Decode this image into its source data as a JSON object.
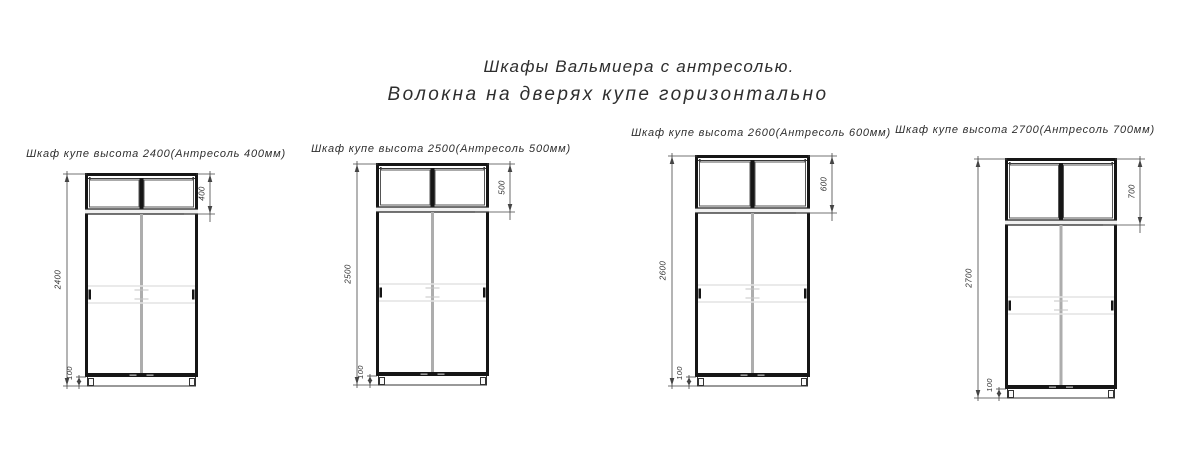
{
  "titles": {
    "line1": "Шкафы Вальмиера с антресолью.",
    "line2": "Волокна на дверях купе горизонтально"
  },
  "cabinets": [
    {
      "label": "Шкаф купе высота 2400(Антресоль 400мм)",
      "height_mm": "2400",
      "mezzanine_mm": "400",
      "plinth_mm": "100"
    },
    {
      "label": "Шкаф купе высота 2500(Антресоль 500мм)",
      "height_mm": "2500",
      "mezzanine_mm": "500",
      "plinth_mm": "100"
    },
    {
      "label": "Шкаф купе высота 2600(Антресоль 600мм)",
      "height_mm": "2600",
      "mezzanine_mm": "600",
      "plinth_mm": "100"
    },
    {
      "label": "Шкаф купе высота 2700(Антресоль 700мм)",
      "height_mm": "2700",
      "mezzanine_mm": "700",
      "plinth_mm": "100"
    }
  ],
  "colors": {
    "ink": "#161616",
    "thin_line": "#3a3a3a",
    "dim_line": "#444444",
    "joint_gray": "#adadad",
    "profile_light": "#e3e3e3",
    "tick_gray": "#c4c4c4",
    "guide_gray": "#9a9a9a",
    "text": "#2e2e2e",
    "background": "#ffffff"
  }
}
